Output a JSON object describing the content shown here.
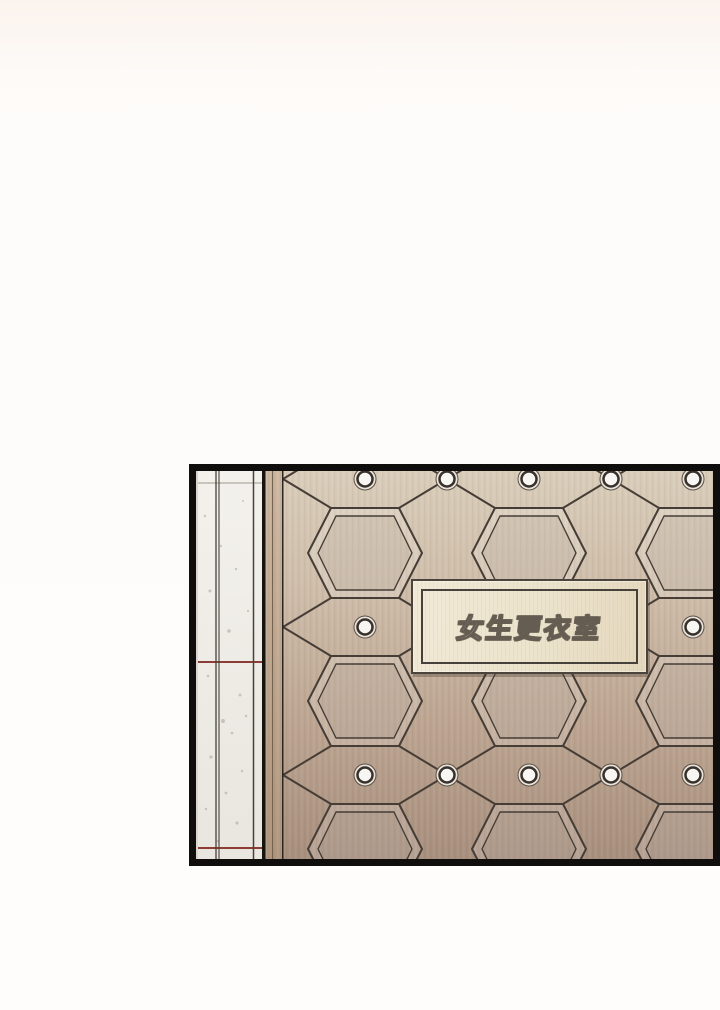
{
  "scene": {
    "description_label": "comic-panel-of-changing-room-door"
  },
  "sign": {
    "text": "女生更衣室"
  },
  "palette": {
    "page_bg_top": "#fbf3ee",
    "page_bg": "#fefcfa",
    "panel_border": "#100e0c",
    "marble_light": "#f3f1ec",
    "marble_dark": "#e9e6df",
    "marble_line": "#47413a",
    "marble_seam": "#c8c4bb",
    "speckle": "#b3ada3",
    "red_line": "#8e3d36",
    "frame_black": "#17130f",
    "frame_tan_top": "#cdb8a3",
    "frame_tan_bottom": "#b0977f",
    "door_top": "#d9cdba",
    "door_upper": "#cdbca9",
    "door_lower": "#bba491",
    "door_bottom": "#a78f7e",
    "seam": "#453d36",
    "rivet_outer": "#e7e2da",
    "rivet_outer_edge": "#5d5146",
    "rivet_center": "#f8f6f2",
    "rivet_ring": "#38302a",
    "plaque_bg": "#ece3cc",
    "plaque_border": "#46413b",
    "sign_text_color": "#ffffff",
    "sign_text_outline": "#665d52"
  }
}
